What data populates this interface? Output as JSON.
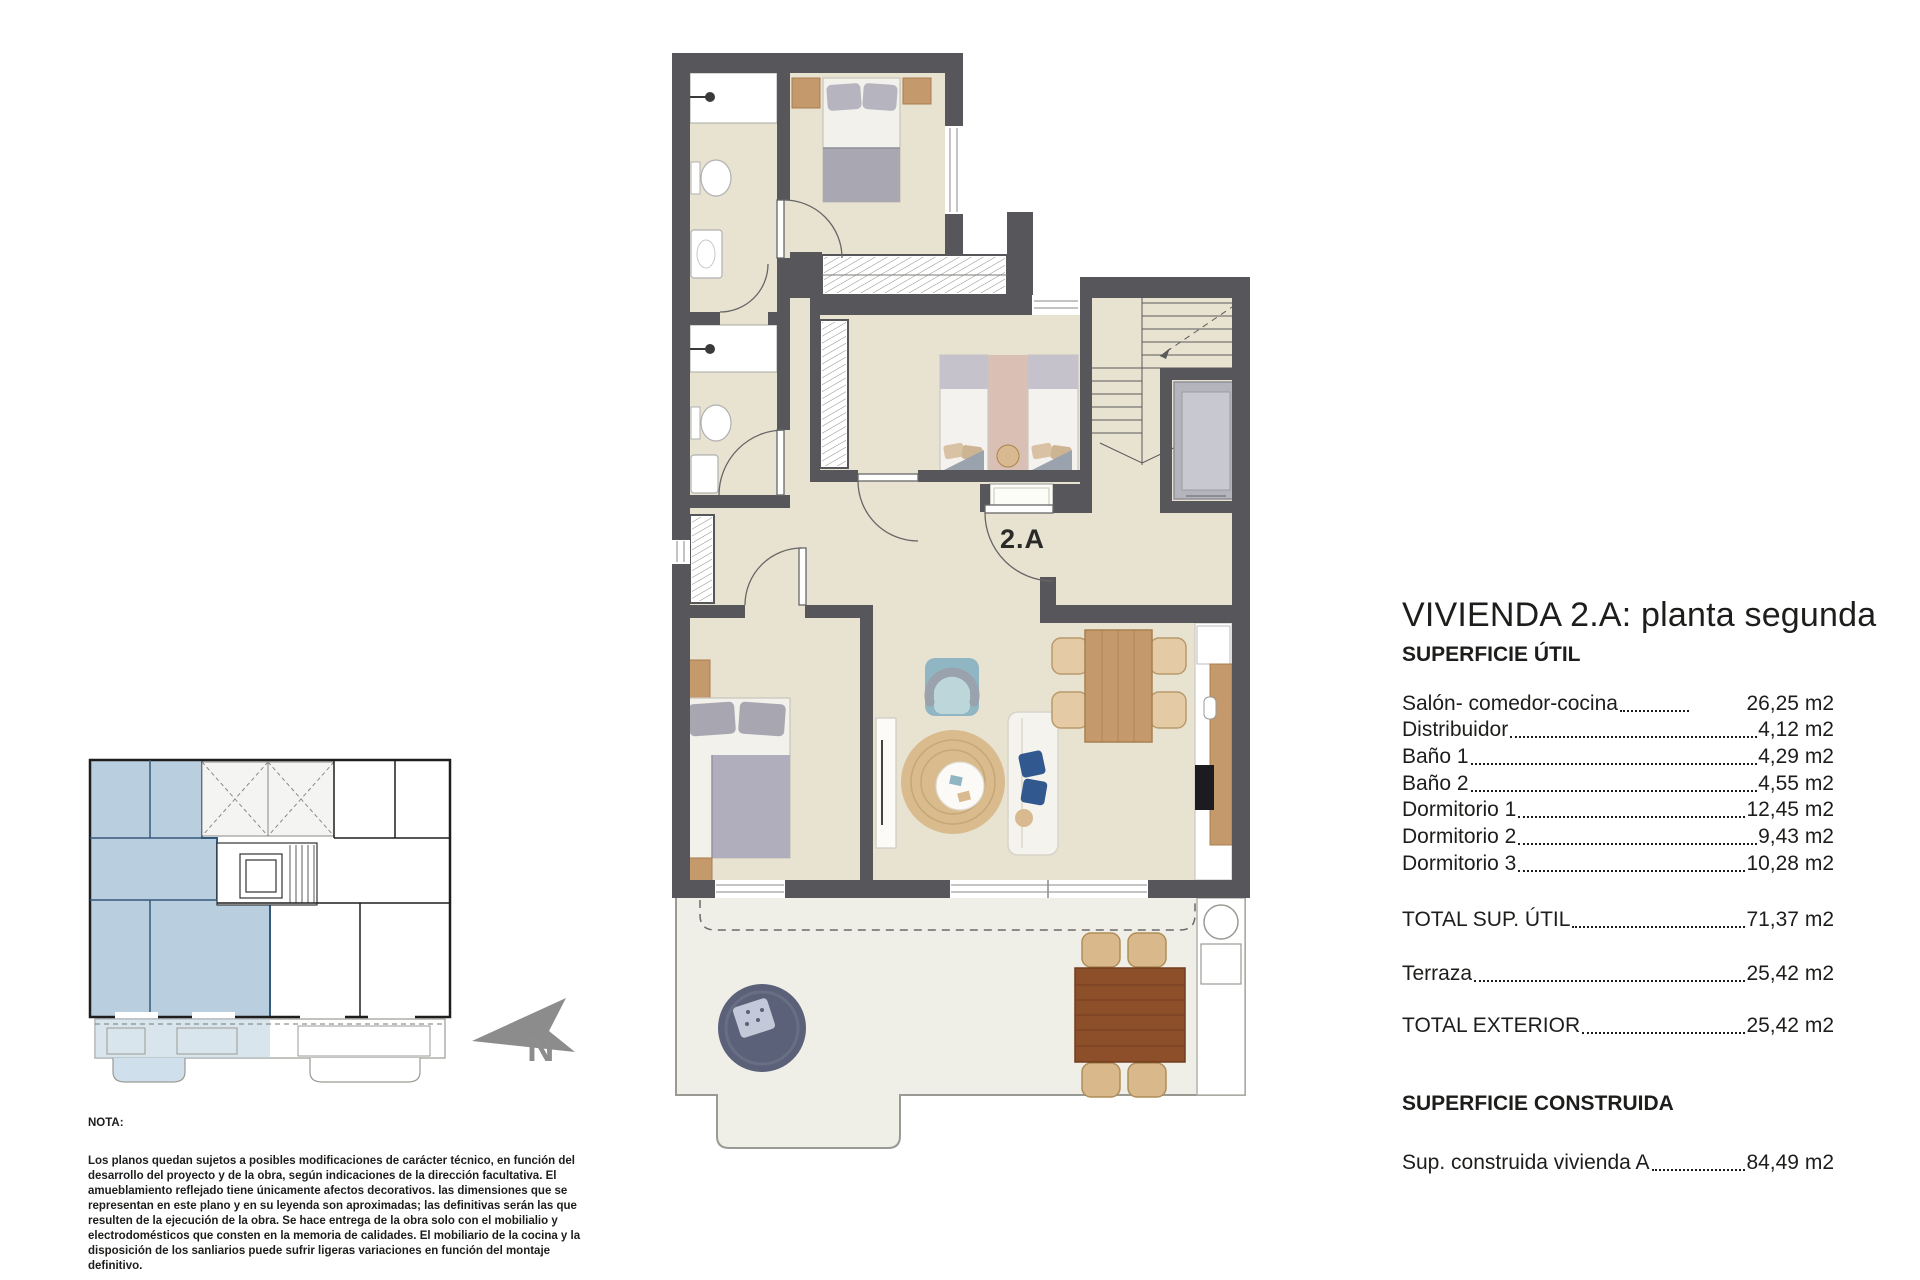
{
  "plan": {
    "unit_label": "2.A"
  },
  "compass": {
    "north_label": "N"
  },
  "panel": {
    "title": "VIVIENDA 2.A: planta segunda",
    "section_util": "SUPERFICIE ÚTIL",
    "rows": [
      {
        "label": "Salón- comedor-cocina",
        "value": "26,25 m2",
        "short": true
      },
      {
        "label": "Distribuidor",
        "value": "4,12 m2"
      },
      {
        "label": "Baño 1",
        "value": "4,29 m2"
      },
      {
        "label": "Baño 2",
        "value": "4,55 m2"
      },
      {
        "label": "Dormitorio 1",
        "value": "12,45 m2"
      },
      {
        "label": "Dormitorio 2",
        "value": "9,43 m2"
      },
      {
        "label": "Dormitorio 3",
        "value": "10,28 m2"
      }
    ],
    "total_util": {
      "label": "TOTAL SUP. ÚTIL",
      "value": "71,37 m2"
    },
    "terraza": {
      "label": "Terraza",
      "value": "25,42 m2"
    },
    "total_exterior": {
      "label": "TOTAL EXTERIOR",
      "value": "25,42 m2"
    },
    "section_construida": "SUPERFICIE CONSTRUIDA",
    "sup_construida": {
      "label": "Sup. construida vivienda A",
      "value": "84,49 m2"
    }
  },
  "nota": {
    "title": "NOTA:",
    "body": "Los planos quedan sujetos a posibles modificaciones de carácter técnico, en función del desarrollo del proyecto y de la obra, según indicaciones de la dirección facultativa. El amueblamiento reflejado tiene únicamente afectos decorativos. las dimensiones que se representan en este plano y en su leyenda son aproximadas; las definitivas serán las que resulten de la ejecución de la obra. Se hace entrega de la obra solo con el mobilialio y electrodomésticos que consten en la memoria de calidades. El mobiliario de la cocina y la disposición de los sanliarios puede sufrir ligeras variaciones en función del montaje definitivo."
  },
  "colors": {
    "wall": "#57565a",
    "floor": "#e8e2d1",
    "terrace_floor": "#f0efe7",
    "highlight_blue": "#b9cfdf",
    "north_gray": "#8d8d8d",
    "wood": "#c49a6c",
    "terrace_wood": "#8d4e2a"
  }
}
